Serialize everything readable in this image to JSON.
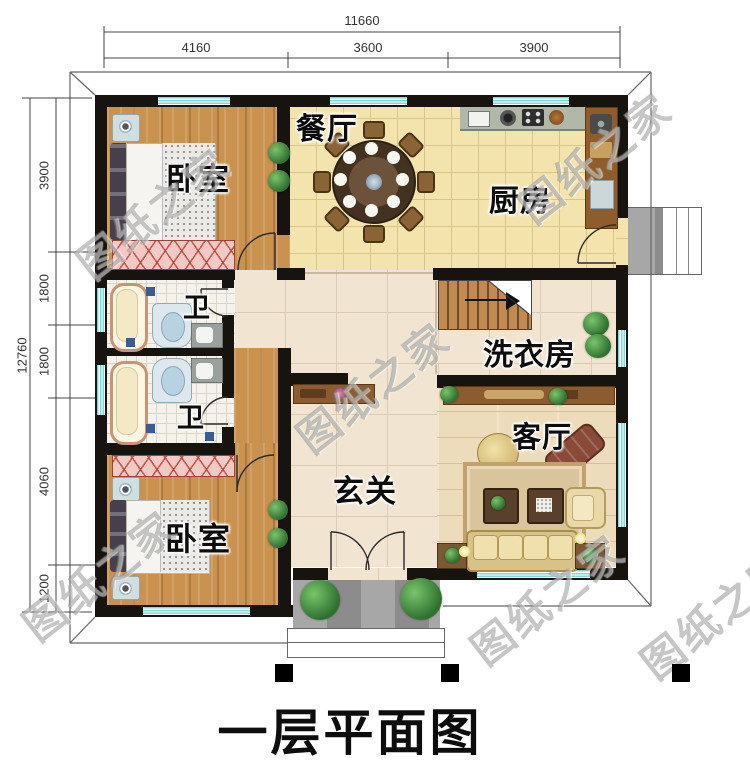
{
  "title": "一层平面图",
  "watermark_text": "图纸之家",
  "dimensions": {
    "top": {
      "total": "11660",
      "seg1": "4160",
      "seg2": "3600",
      "seg3": "3900"
    },
    "left": {
      "total": "12760",
      "seg1": "3900",
      "seg2": "1800",
      "seg3": "1800",
      "seg4": "4060",
      "seg5": "1200"
    }
  },
  "rooms": {
    "bedroom_top": "卧室",
    "bedroom_bottom": "卧室",
    "dining": "餐厅",
    "kitchen": "厨房",
    "bath_top": "卫",
    "bath_bottom": "卫",
    "laundry": "洗衣房",
    "living": "客厅",
    "entry": "玄关"
  },
  "colors": {
    "wall": "#17130f",
    "window_glass": "#7bdad4",
    "wood_floor": "#c28a4e",
    "tile_yellow": "#f3e4ae",
    "tile_beige": "#f1e4d0",
    "living_wood": "#eddcbc",
    "wardrobe_pink": "#f3c9c4",
    "porch_gray": "#989898"
  }
}
